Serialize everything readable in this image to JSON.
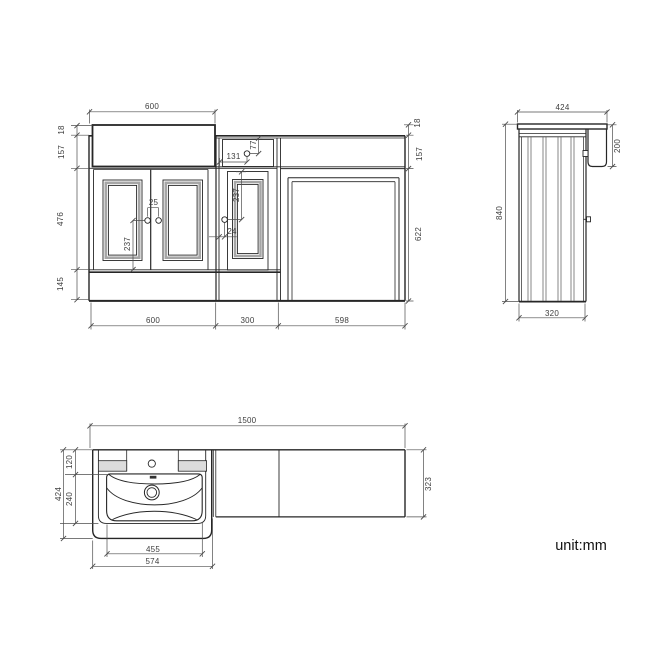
{
  "unit_note": "unit:mm",
  "style": {
    "line_color": "#262626",
    "dim_color": "#4d4d4d",
    "molding_gray": "#a6a6a6",
    "background": "#ffffff"
  },
  "front": {
    "top_width": "600",
    "left": {
      "counter_lip": "18",
      "fascia": "157",
      "door_height": "476",
      "plinth": "145"
    },
    "right": {
      "counter_lip": "18",
      "fascia": "157",
      "body_height": "622"
    },
    "bottom": {
      "vanity": "600",
      "middle": "300",
      "wc": "598"
    },
    "inner": {
      "knob_gap": "25",
      "left_knob_drop": "237",
      "drawer_knob_offset_x": "131",
      "drawer_knob_offset_y": "77",
      "mid_knob_drop": "237",
      "mid_knob_offset": "24"
    }
  },
  "side": {
    "top_depth": "424",
    "basin_apron_drop": "200",
    "height": "840",
    "cabinet_depth": "320"
  },
  "plan": {
    "total_width": "1500",
    "deck_depth": "120",
    "bowl_depth": "240",
    "total_depth": "424",
    "bowl_width": "455",
    "basin_width": "574",
    "counter_depth": "323"
  }
}
